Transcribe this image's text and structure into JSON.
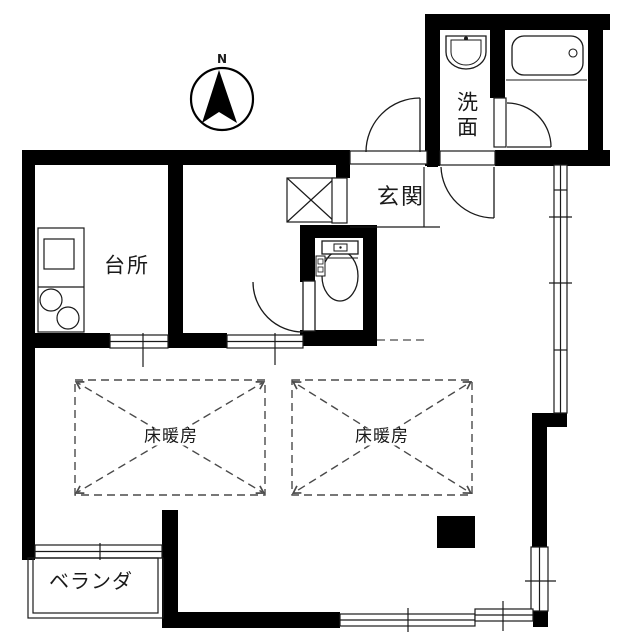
{
  "compass": {
    "north_label": "N"
  },
  "rooms": {
    "kitchen": {
      "label": "台所"
    },
    "entrance": {
      "label": "玄関"
    },
    "washroom": {
      "label": "洗面"
    },
    "floor_heating_left": {
      "label": "床暖房"
    },
    "floor_heating_right": {
      "label": "床暖房"
    },
    "veranda": {
      "label": "ベランダ"
    }
  },
  "fixtures": {
    "icons": [
      "north-compass",
      "kitchen-counter",
      "kitchen-sink",
      "stove-burners",
      "washbasin",
      "bathtub",
      "toilet",
      "pipe-shaft",
      "floor-heating-area"
    ]
  },
  "colors": {
    "wall": "#000000",
    "line": "#1a1a1a",
    "dashed_line": "#4a4a4a",
    "background": "#ffffff"
  }
}
